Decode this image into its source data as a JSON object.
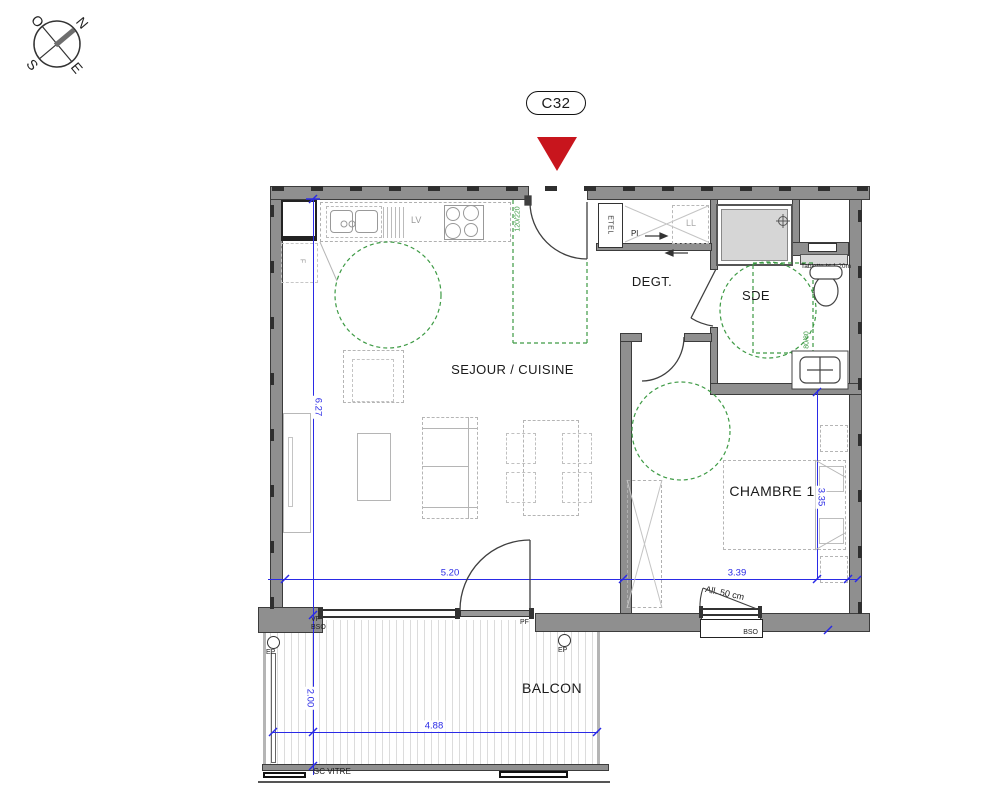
{
  "plan": {
    "unit_label": "C32",
    "compass": {
      "n": "N",
      "e": "E",
      "s": "S",
      "o": "O"
    },
    "rooms": {
      "sejour": "SEJOUR / CUISINE",
      "degt": "DEGT.",
      "sde": "SDE",
      "chambre": "CHAMBRE 1",
      "balcon": "BALCON"
    },
    "dimensions": {
      "sejour_width": "5.20",
      "sejour_depth": "6.27",
      "chambre_width": "3.39",
      "chambre_depth": "3.35",
      "balcon_depth": "2.00",
      "balcon_width": "4.88"
    },
    "annotations": {
      "entry_door_size": "120/220",
      "shower_size": "80/80",
      "dishwasher": "LV",
      "washing_machine": "LL",
      "closet": "Pl.",
      "etel": "ETEL",
      "fridge": "F",
      "vf": "VF",
      "bso_left": "BSO",
      "bso_window": "BSO",
      "pf": "PF",
      "ep_left": "EP",
      "ep_right": "EP",
      "gc_vitre": "GC VITRE",
      "allege": "All. 50 cm",
      "tablette": "Tablette ht 1.20m"
    },
    "colors": {
      "dimension_blue": "#2a2ae6",
      "accessibility_green": "#3d9a44",
      "marker_red": "#c8151d",
      "wall_gray": "#8f8f8f"
    }
  }
}
